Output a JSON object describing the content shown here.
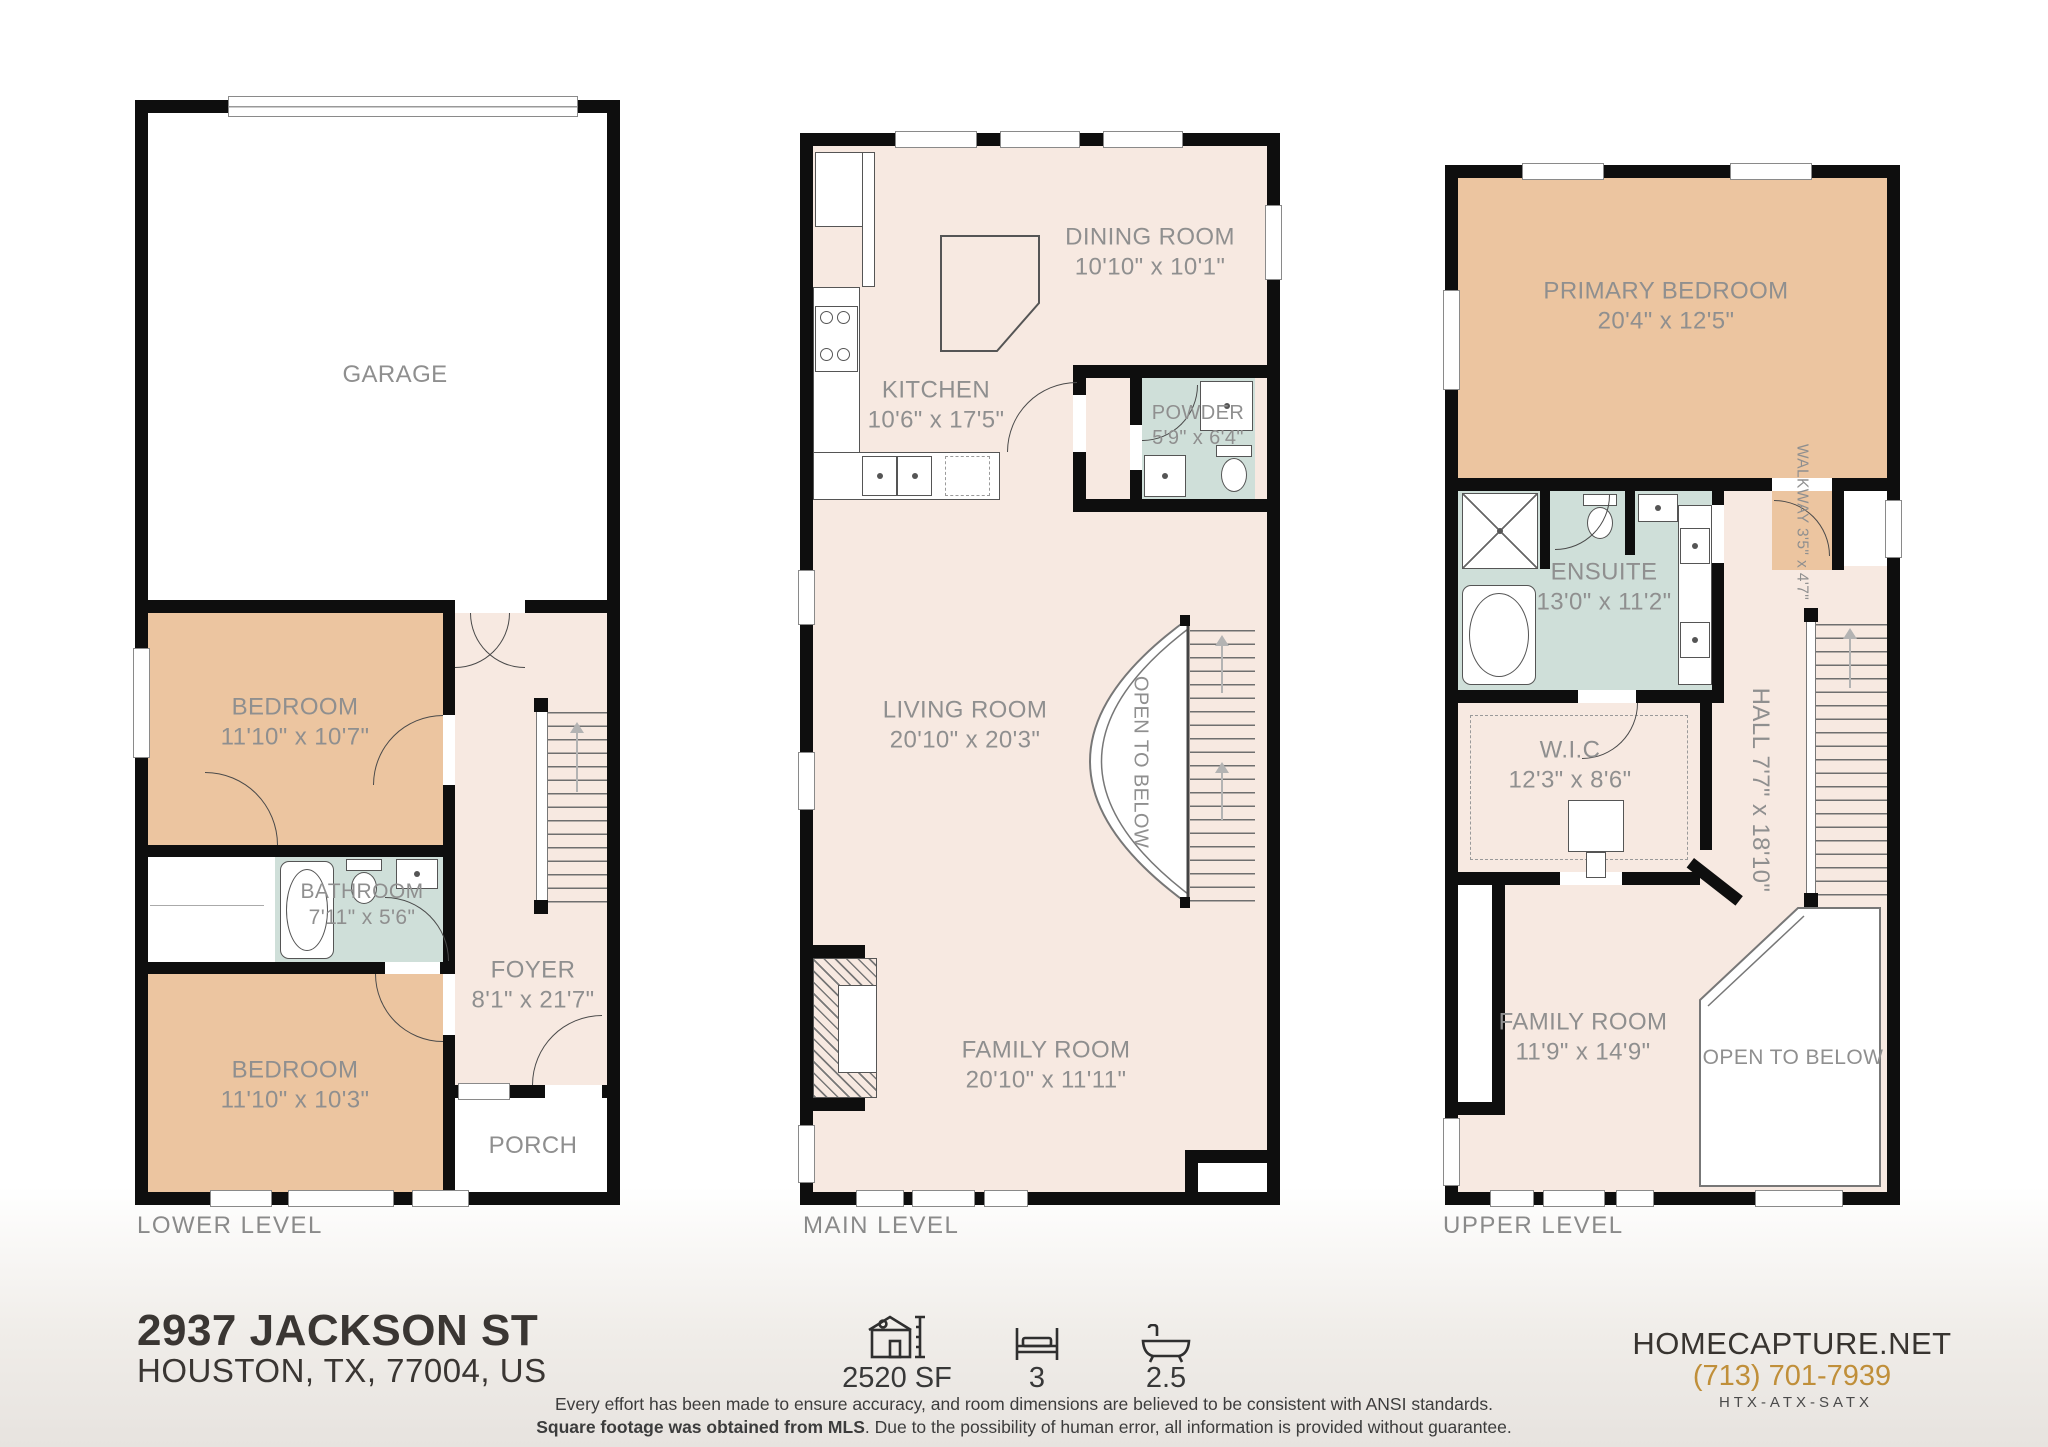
{
  "colors": {
    "wall": "#0e0e0e",
    "floor_pink": "#f7e9e1",
    "bedroom_tan": "#ecc5a0",
    "bath_green": "#cfdfd9",
    "label_gray": "#8f8f8f",
    "brand_gold": "#c08f3a"
  },
  "floors": [
    {
      "name": "LOWER LEVEL",
      "rooms": {
        "garage": {
          "label": "GARAGE",
          "dims": ""
        },
        "bedroom1": {
          "label": "BEDROOM",
          "dims": "11'10\" x 10'7\""
        },
        "bathroom": {
          "label": "BATHROOM",
          "dims": "7'11\" x 5'6\""
        },
        "bedroom2": {
          "label": "BEDROOM",
          "dims": "11'10\" x 10'3\""
        },
        "foyer": {
          "label": "FOYER",
          "dims": "8'1\" x 21'7\""
        },
        "porch": {
          "label": "PORCH",
          "dims": ""
        }
      }
    },
    {
      "name": "MAIN LEVEL",
      "rooms": {
        "dining": {
          "label": "DINING ROOM",
          "dims": "10'10\" x 10'1\""
        },
        "kitchen": {
          "label": "KITCHEN",
          "dims": "10'6\" x 17'5\""
        },
        "powder": {
          "label": "POWDER",
          "dims": "5'9\" x 6'4\""
        },
        "living": {
          "label": "LIVING ROOM",
          "dims": "20'10\" x 20'3\""
        },
        "open_below": {
          "label": "OPEN TO BELOW",
          "dims": ""
        },
        "family": {
          "label": "FAMILY ROOM",
          "dims": "20'10\" x 11'11\""
        }
      }
    },
    {
      "name": "UPPER LEVEL",
      "rooms": {
        "primary": {
          "label": "PRIMARY BEDROOM",
          "dims": "20'4\" x 12'5\""
        },
        "walkway": {
          "label": "WALKWAY",
          "dims": "3'5\" x 4'7\""
        },
        "ensuite": {
          "label": "ENSUITE",
          "dims": "13'0\" x 11'2\""
        },
        "wic": {
          "label": "W.I.C",
          "dims": "12'3\" x 8'6\""
        },
        "hall": {
          "label": "HALL",
          "dims": "7'7\" x 18'10\""
        },
        "family": {
          "label": "FAMILY ROOM",
          "dims": "11'9\" x 14'9\""
        },
        "open_below": {
          "label": "OPEN TO BELOW",
          "dims": ""
        }
      }
    }
  ],
  "footer": {
    "address_line1": "2937 JACKSON ST",
    "address_line2": "HOUSTON, TX, 77004, US",
    "sqft": "2520 SF",
    "beds": "3",
    "baths": "2.5",
    "disclaimer_line1": "Every effort has been made to ensure accuracy, and room dimensions are believed to be consistent with ANSI standards.",
    "disclaimer_line2_bold": "Square footage was obtained from MLS",
    "disclaimer_line2_rest": ". Due to the possibility of human error, all information is provided without guarantee.",
    "brand": "HOMECAPTURE.NET",
    "phone": "(713) 701-7939",
    "tagline": "HTX-ATX-SATX"
  }
}
